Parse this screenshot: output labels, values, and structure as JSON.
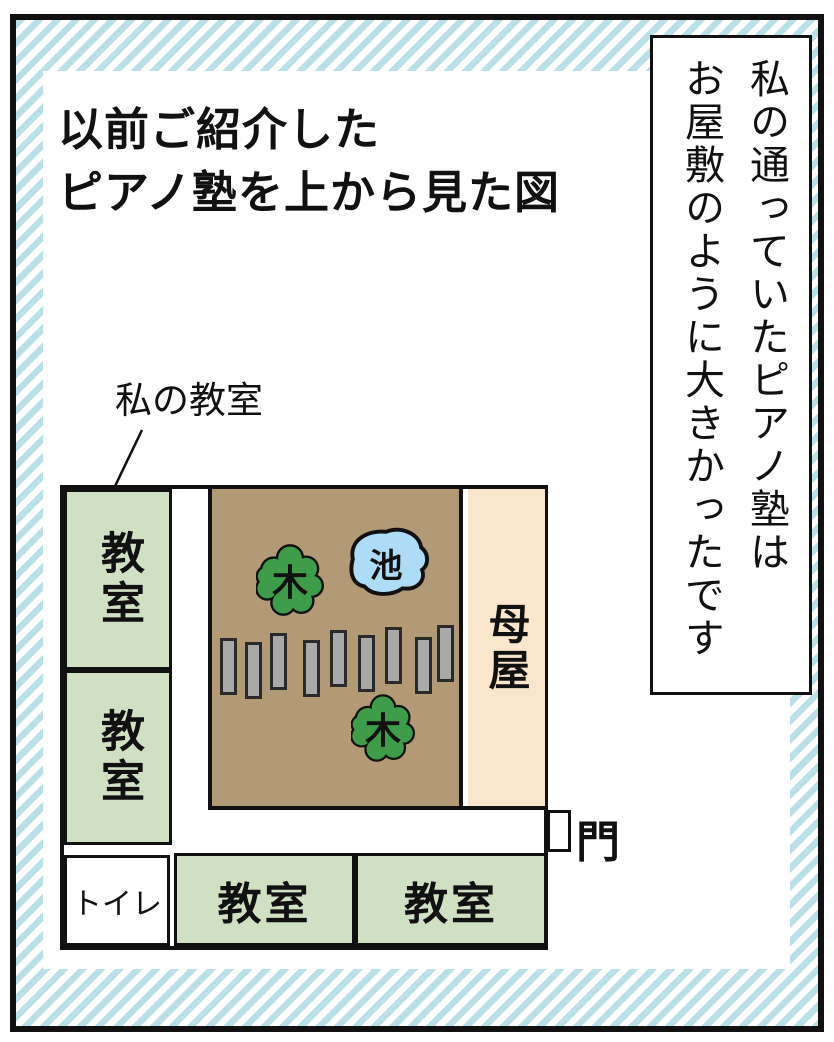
{
  "header": {
    "title": "以前ご紹介した\nピアノ塾を上から見た図"
  },
  "side_note": {
    "text": "私の通っていたピアノ塾は\nお屋敷のように大きかったです"
  },
  "map": {
    "pointer_label": "私の教室",
    "rooms": {
      "left_top": "教室",
      "left_bottom": "教室",
      "toilet": "トイレ",
      "bottom_center": "教室",
      "bottom_right": "教室",
      "main_house": "母屋"
    },
    "garden": {
      "tree_label": "木",
      "pond_label": "池",
      "stone_count": 9
    },
    "gate_label": "門"
  },
  "colors": {
    "stripe_blue": "#b9e0e6",
    "room_green": "#cfe0c3",
    "garden_brown": "#b19a75",
    "main_house_peach": "#fae5cd",
    "pond_blue": "#aedcf7",
    "tree_green": "#3e9c4a",
    "stone_gray": "#a9a9a9",
    "ink": "#111111"
  }
}
